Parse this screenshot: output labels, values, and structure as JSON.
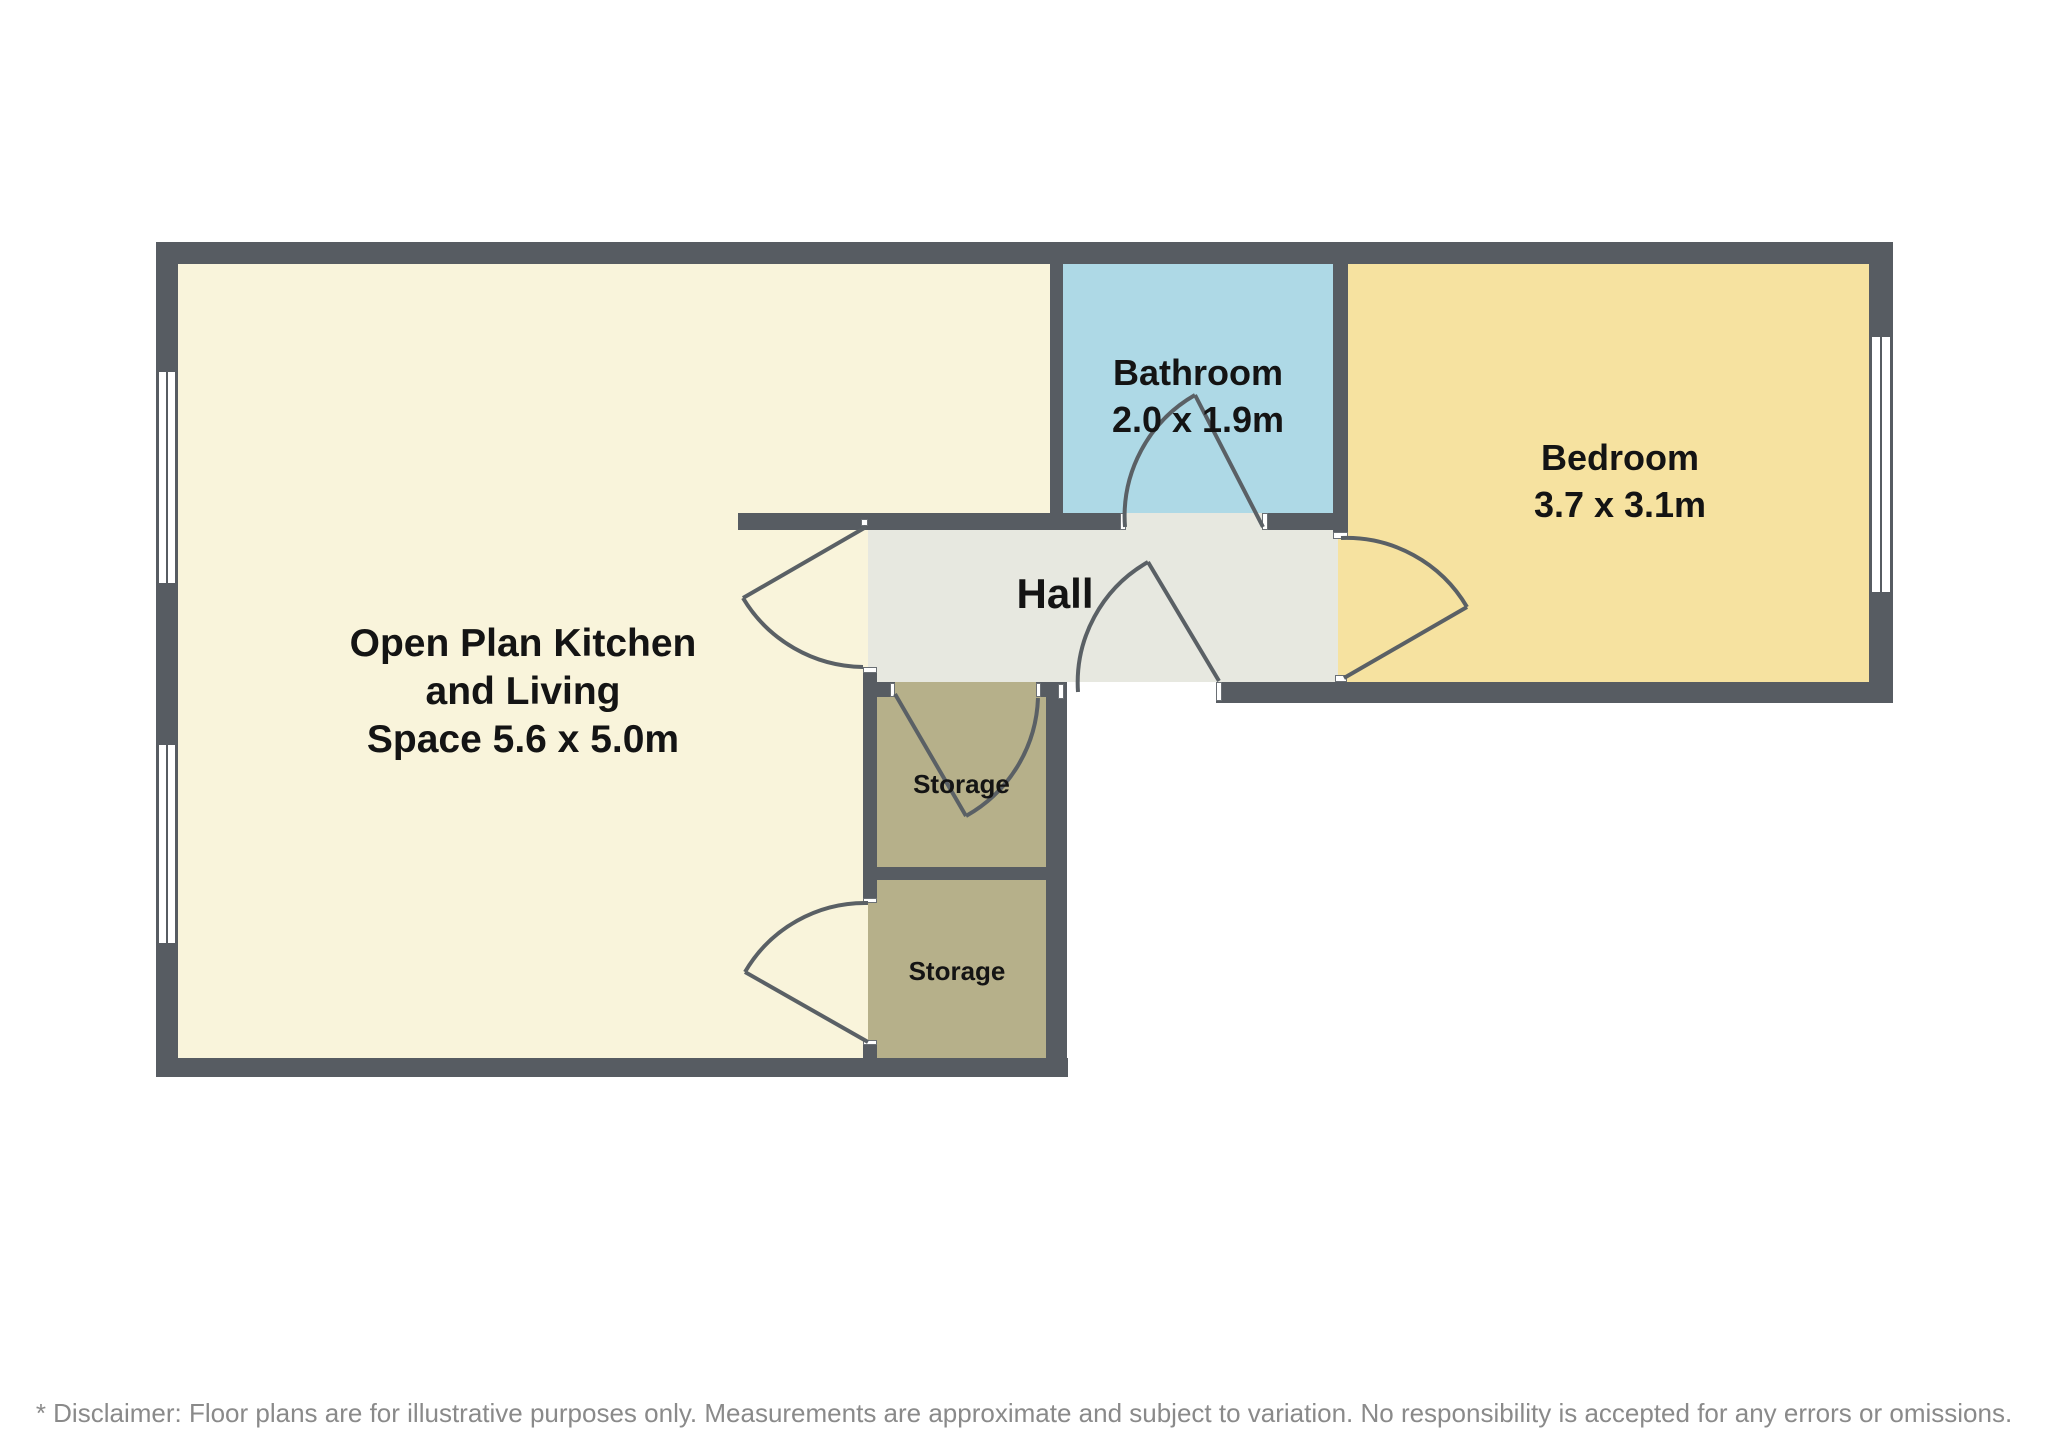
{
  "page": {
    "type": "floor-plan",
    "background": "#ffffff"
  },
  "rooms": {
    "kitchen": {
      "lines": [
        "Open Plan Kitchen",
        "and Living",
        "Space 5.6 x 5.0m"
      ],
      "name": "Open Plan Kitchen and Living Space",
      "dimensions": "5.6 x 5.0m"
    },
    "bathroom": {
      "name": "Bathroom",
      "dimensions": "2.0 x 1.9m"
    },
    "bedroom": {
      "name": "Bedroom",
      "dimensions": "3.7 x 3.1m"
    },
    "hall": {
      "name": "Hall"
    },
    "storage_top": {
      "name": "Storage"
    },
    "storage_bottom": {
      "name": "Storage"
    }
  },
  "glyphs": {
    "door": "quarter-circle-door-swing",
    "window": "double-line-window",
    "door_count": 6,
    "window_count": 3
  },
  "disclaimer": "* Disclaimer: Floor plans are for illustrative purposes only. Measurements are approximate and subject to variation. No responsibility is accepted for any errors or omissions.",
  "colors": {
    "wall": "#575c62",
    "kitchen": "#f9f4db",
    "bathroom": "#aed9e6",
    "bedroom": "#f6e2a0",
    "hall": "#e7e8e0",
    "storage": "#b6b08a",
    "door_line": "#5a6065",
    "label_text": "#141414",
    "disclaimer_text": "#8a8a8a",
    "background": "#ffffff"
  }
}
